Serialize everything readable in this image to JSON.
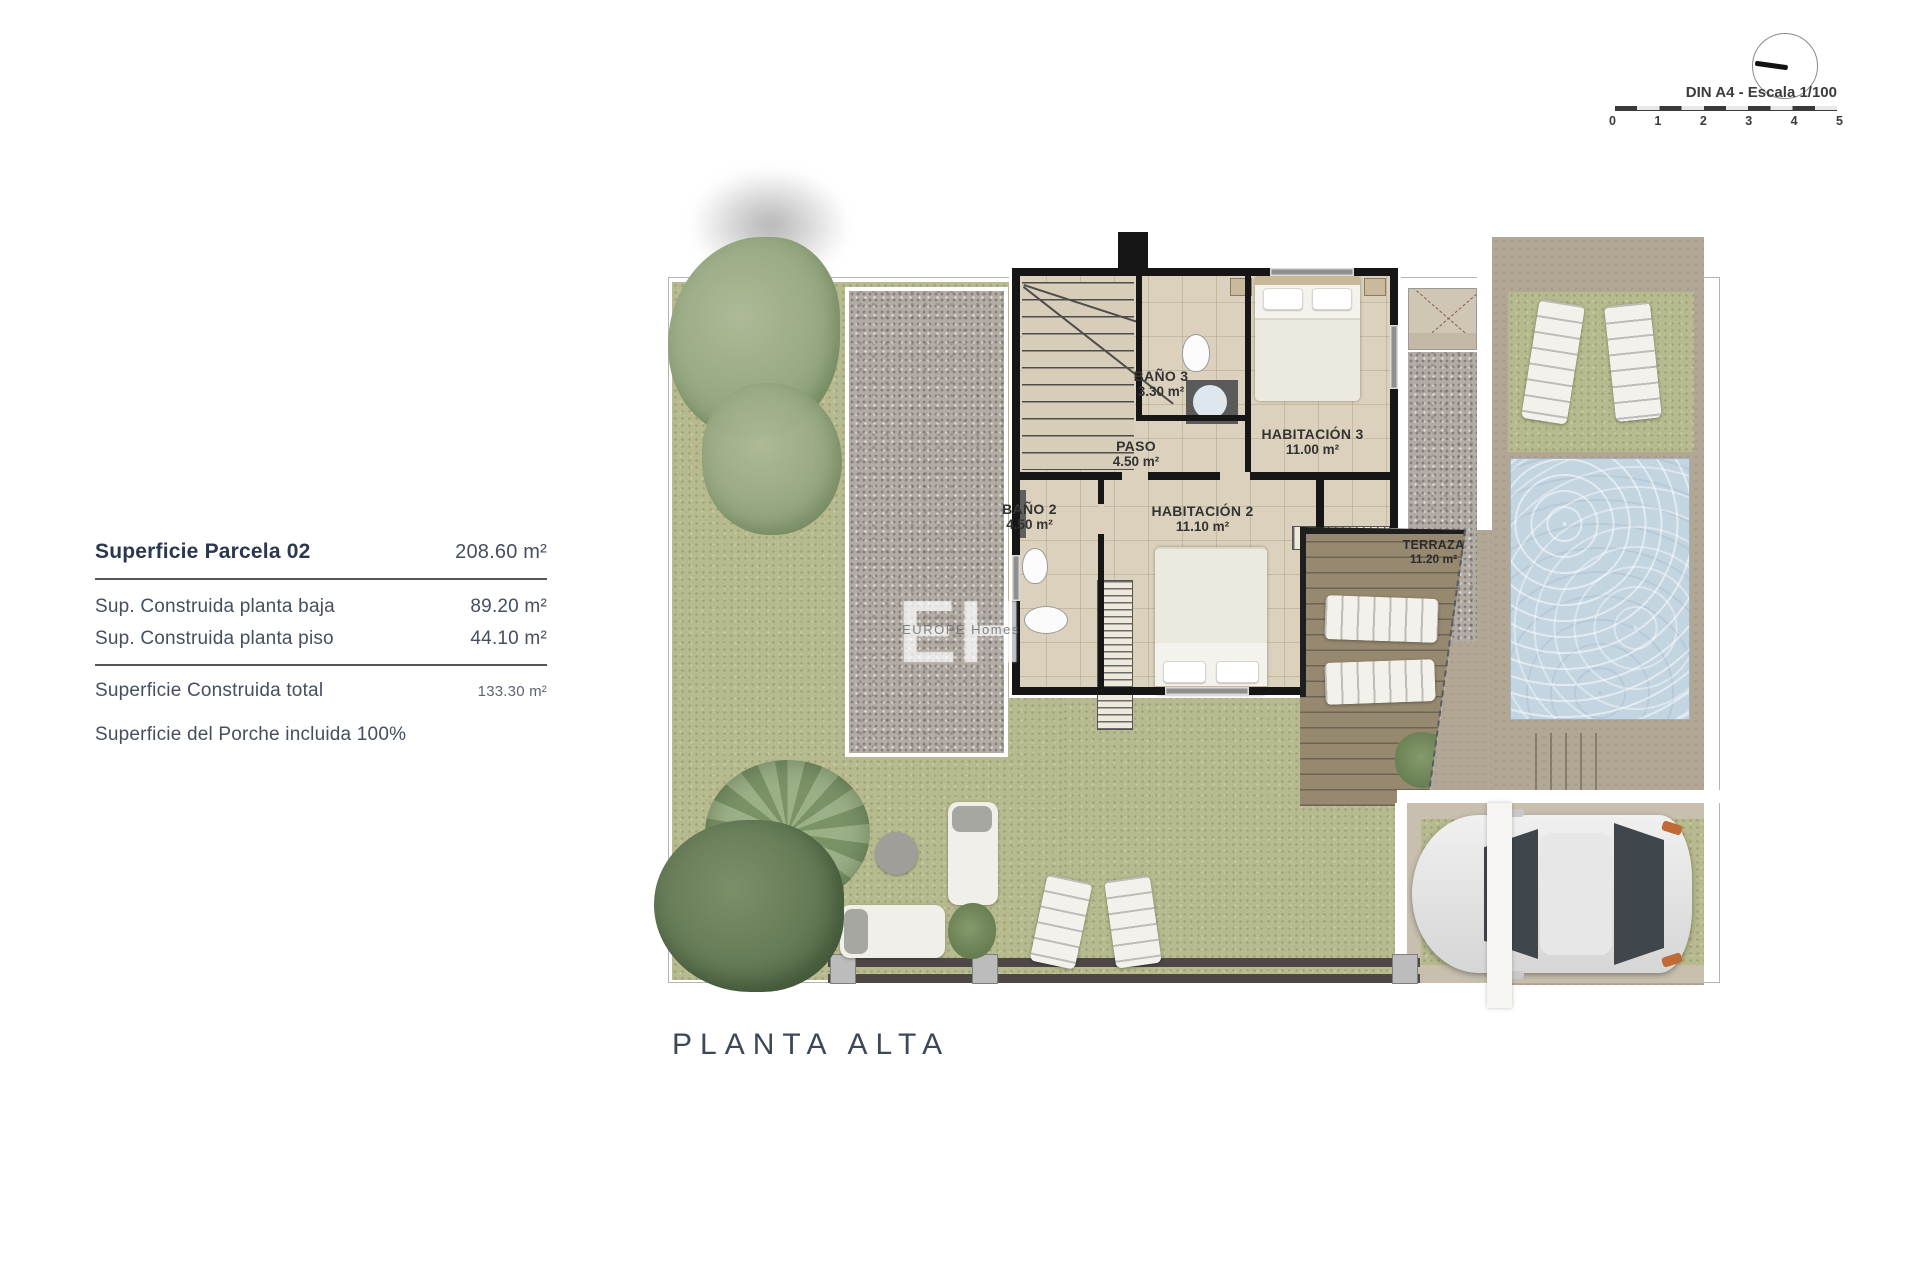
{
  "scale": {
    "label": "DIN A4 - Escala 1/100",
    "ticks": [
      "0",
      "1",
      "2",
      "3",
      "4",
      "5"
    ]
  },
  "info": {
    "rows": [
      {
        "label": "Superficie Parcela 02",
        "value": "208.60 m²"
      },
      {
        "label": "Sup. Construida planta baja",
        "value": "89.20 m²"
      },
      {
        "label": "Sup. Construida planta piso",
        "value": "44.10 m²"
      },
      {
        "label": "Superficie Construida total",
        "value": "133.30 m²"
      },
      {
        "label": "Superficie del Porche incluida 100%",
        "value": ""
      }
    ]
  },
  "plan": {
    "title": "PLANTA ALTA",
    "watermark": {
      "initials": "EH",
      "text": "EUROPE Homes"
    },
    "rooms": [
      {
        "name": "BAÑO 3",
        "area": "3.30 m²"
      },
      {
        "name": "PASO",
        "area": "4.50 m²"
      },
      {
        "name": "HABITACIÓN 3",
        "area": "11.00 m²"
      },
      {
        "name": "BAÑO 2",
        "area": "4.50 m²"
      },
      {
        "name": "HABITACIÓN 2",
        "area": "11.10 m²"
      },
      {
        "name": "TERRAZA",
        "area": "11.20 m²"
      }
    ]
  },
  "colors": {
    "grass": "#b7ba8e",
    "gravel": "#b3aca5",
    "floor": "#dbd1bc",
    "wall": "#161616",
    "pool": "#c4d5e2",
    "terrace": "#97896f",
    "deck": "#b2a695",
    "text_navy": "#2b3750",
    "label_gray": "#333333",
    "fence": "#4e4745"
  }
}
